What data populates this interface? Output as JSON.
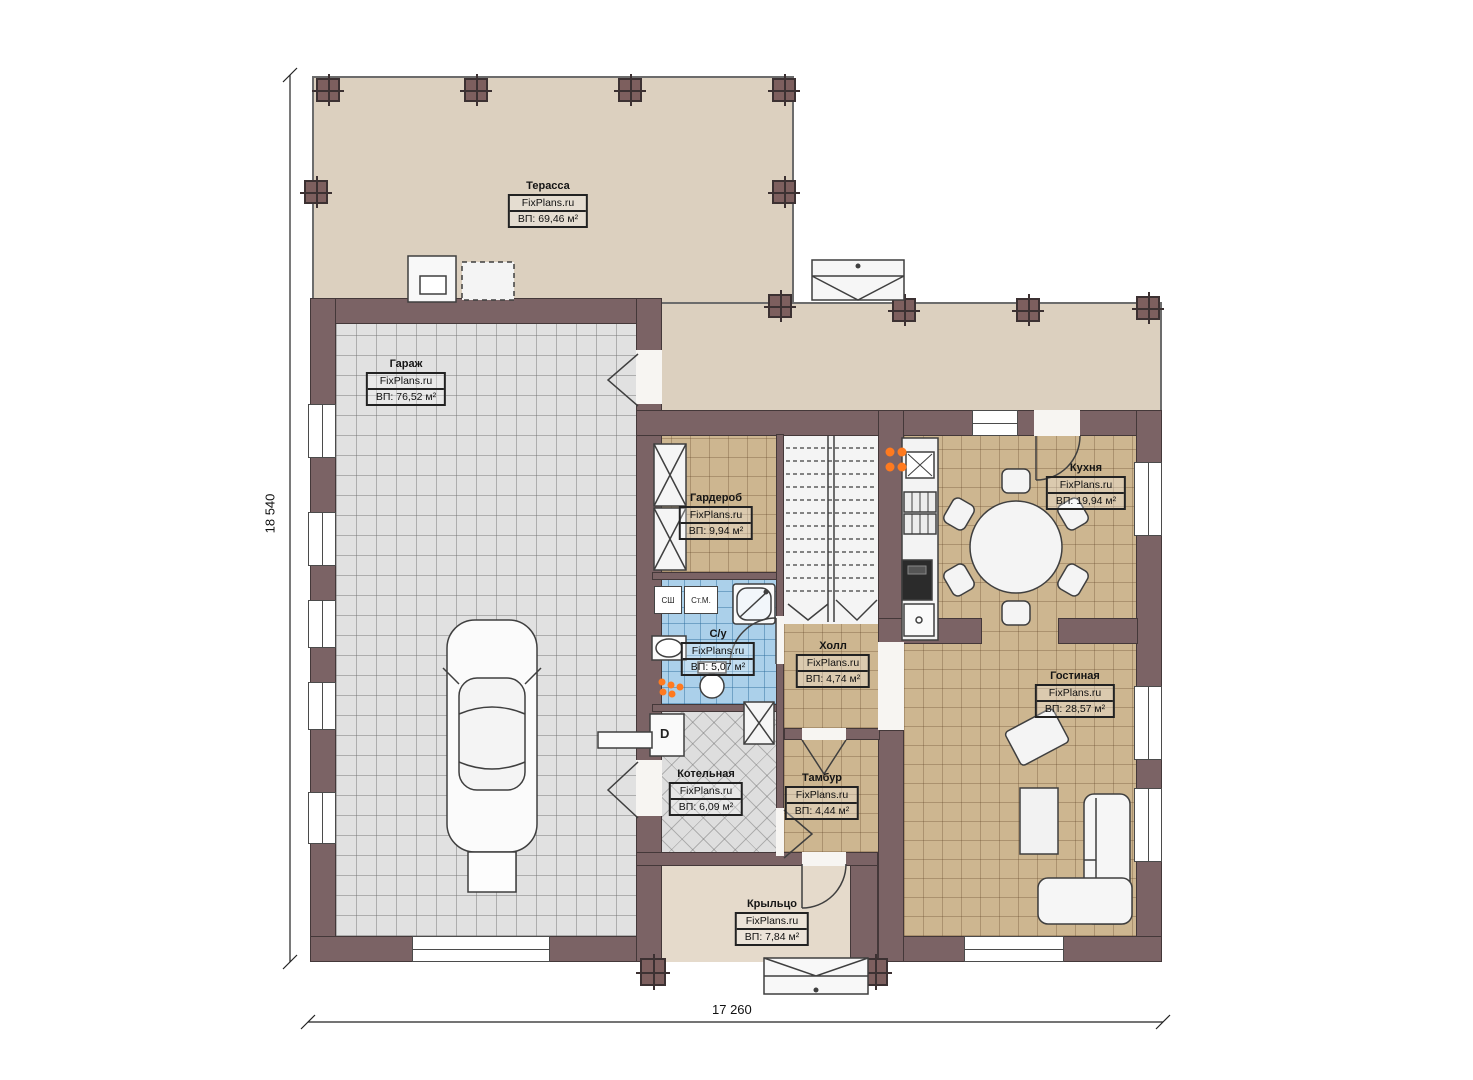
{
  "brand": "FixPlans.ru",
  "dimensions": {
    "vertical": "18 540",
    "horizontal": "17 260"
  },
  "rooms": [
    {
      "key": "terrace",
      "name": "Терасса",
      "area": "ВП: 69,46 м²"
    },
    {
      "key": "garage",
      "name": "Гараж",
      "area": "ВП: 76,52 м²"
    },
    {
      "key": "wardrobe",
      "name": "Гардероб",
      "area": "ВП: 9,94 м²"
    },
    {
      "key": "kitchen",
      "name": "Кухня",
      "area": "ВП: 19,94 м²"
    },
    {
      "key": "bathroom",
      "name": "С/у",
      "area": "ВП: 5,07 м²"
    },
    {
      "key": "hall",
      "name": "Холл",
      "area": "ВП: 4,74 м²"
    },
    {
      "key": "living",
      "name": "Гостиная",
      "area": "ВП: 28,57 м²"
    },
    {
      "key": "boiler",
      "name": "Котельная",
      "area": "ВП: 6,09 м²"
    },
    {
      "key": "tambour",
      "name": "Тамбур",
      "area": "ВП: 4,44 м²"
    },
    {
      "key": "porch",
      "name": "Крыльцо",
      "area": "ВП: 7,84 м²"
    }
  ],
  "appliances": {
    "washer": "СШ",
    "washing_machine": "Ст.М.",
    "boiler_unit": "D"
  },
  "colors": {
    "wall": "#7b6365",
    "terrace_floor": "#dcd0bf",
    "tile_tan": "#cdb690",
    "tile_gray": "#e1e1e1",
    "tile_blue": "#abd0ea",
    "accent_orange": "#ff7a1f"
  }
}
